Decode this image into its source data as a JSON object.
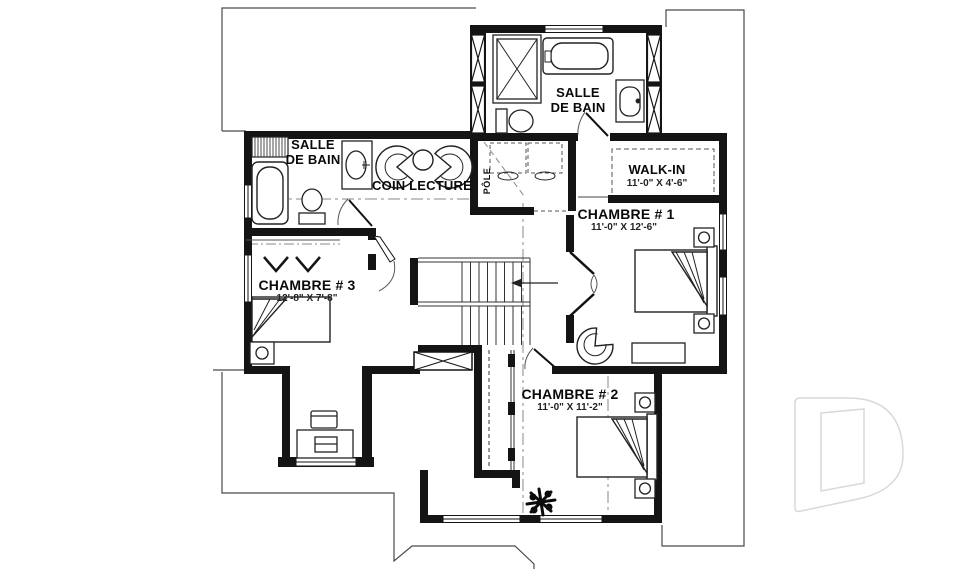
{
  "rooms": {
    "bath_top": {
      "line1": "SALLE",
      "line2": "DE BAIN"
    },
    "bath_left": {
      "line1": "SALLE",
      "line2": "DE BAIN"
    },
    "coin_lecture": {
      "name": "COIN LECTURE"
    },
    "walk_in": {
      "name": "WALK-IN",
      "dims": "11'-0\" X 4'-6\""
    },
    "chambre_1": {
      "name": "CHAMBRE # 1",
      "dims": "11'-0\" X 12'-6\""
    },
    "chambre_2": {
      "name": "CHAMBRE # 2",
      "dims": "11'-0\" X 11'-2\""
    },
    "chambre_3": {
      "name": "CHAMBRE # 3",
      "dims": "12'-8\" X 7'-8\""
    },
    "closet": {
      "label": "PÔLE"
    }
  },
  "colors": {
    "wall": "#141414",
    "thin_line": "#4a4a4a",
    "centerline": "#8a8a8a",
    "watermark": "#d9d9d9",
    "background": "#ffffff"
  }
}
